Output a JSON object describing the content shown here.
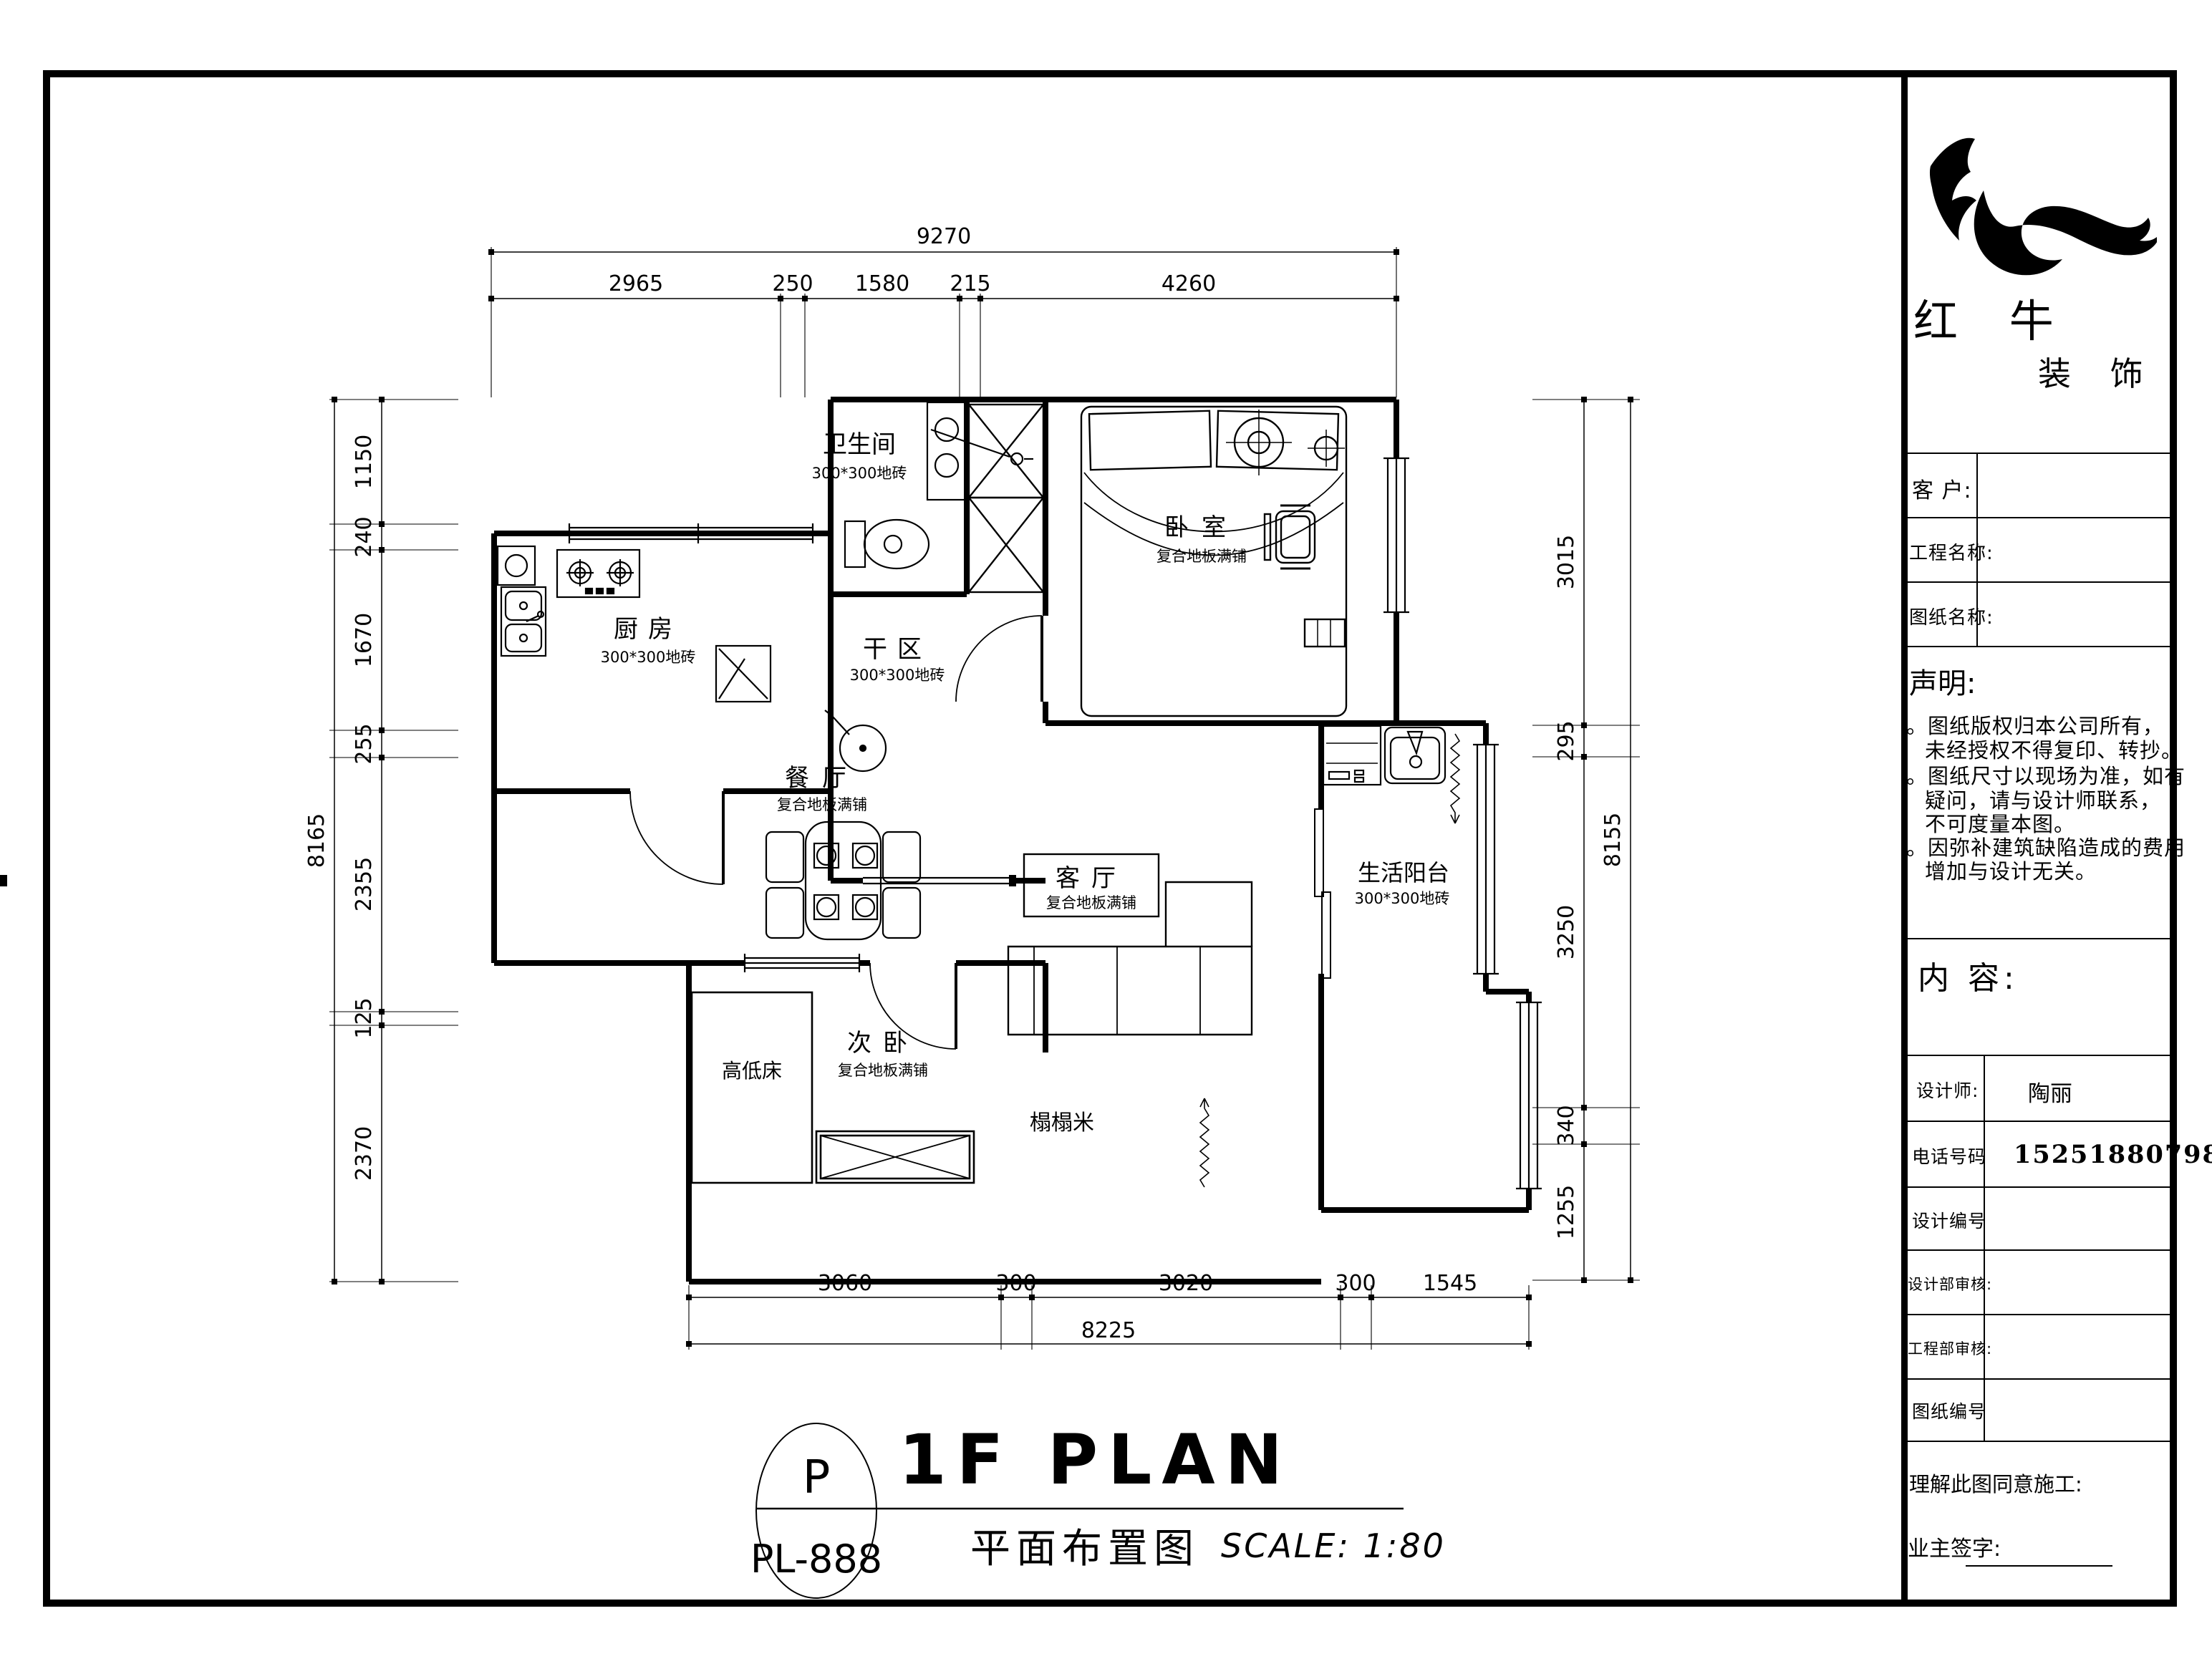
{
  "logo": {
    "title": "红 牛",
    "subtitle": "装 饰"
  },
  "titleblock": {
    "fields": [
      {
        "label": "客 户:"
      },
      {
        "label": "工程名称:"
      },
      {
        "label": "图纸名称:"
      }
    ],
    "statement": {
      "title": "声明:",
      "lines": [
        {
          "text": "。图纸版权归本公司所有，"
        },
        {
          "text": "未经授权不得复印、转抄。"
        },
        {
          "text": "。图纸尺寸以现场为准，如有"
        },
        {
          "text": "疑问，请与设计师联系，"
        },
        {
          "text": "不可度量本图。"
        },
        {
          "text": "。因弥补建筑缺陷造成的费用"
        },
        {
          "text": "增加与设计无关。"
        }
      ]
    },
    "content_label": "内 容:",
    "rows": [
      {
        "label": "设计师:",
        "value": "陶丽"
      },
      {
        "label": "电话号码",
        "value": "15251880798"
      },
      {
        "label": "设计编号",
        "value": ""
      },
      {
        "label": "设计部审核:",
        "value": ""
      },
      {
        "label": "工程部审核:",
        "value": ""
      },
      {
        "label": "图纸编号",
        "value": ""
      }
    ],
    "footer": {
      "agree_label": "理解此图同意施工:",
      "sign_label": "业主签字:"
    }
  },
  "titlebar": {
    "circle_letter": "P",
    "sheet_code": "PL-888",
    "title_en": "1F PLAN",
    "title_cn": "平面布置图",
    "scale": "SCALE: 1:80"
  },
  "plan": {
    "rooms": {
      "bath": {
        "name": "卫生间",
        "floor": "300*300地砖"
      },
      "dry": {
        "name": "干区",
        "floor": "300*300地砖"
      },
      "kitchen": {
        "name": "厨房",
        "floor": "300*300地砖"
      },
      "bedroom": {
        "name": "卧室",
        "floor": "复合地板满铺"
      },
      "dining": {
        "name": "餐厅",
        "floor": "复合地板满铺"
      },
      "living": {
        "name": "客厅",
        "floor": "复合地板满铺"
      },
      "balcony": {
        "name": "生活阳台",
        "floor": "300*300地砖"
      },
      "second_bedroom": {
        "name": "次卧",
        "floor": "复合地板满铺"
      },
      "bunk_bed": {
        "name": "高低床"
      },
      "tatami": {
        "name": "榻榻米"
      }
    },
    "dimensions": {
      "top": {
        "total": "9270",
        "segments": [
          "2965",
          "250",
          "1580",
          "215",
          "4260"
        ]
      },
      "left": {
        "total": "8165",
        "segments": [
          "1150",
          "240",
          "1670",
          "255",
          "2355",
          "125",
          "2370"
        ]
      },
      "right": {
        "total": "8155",
        "segments": [
          "3015",
          "295",
          "3250",
          "340",
          "1255"
        ]
      },
      "bottom": {
        "total": "8225",
        "segments": [
          "3060",
          "300",
          "3020",
          "300",
          "1545"
        ]
      }
    }
  }
}
